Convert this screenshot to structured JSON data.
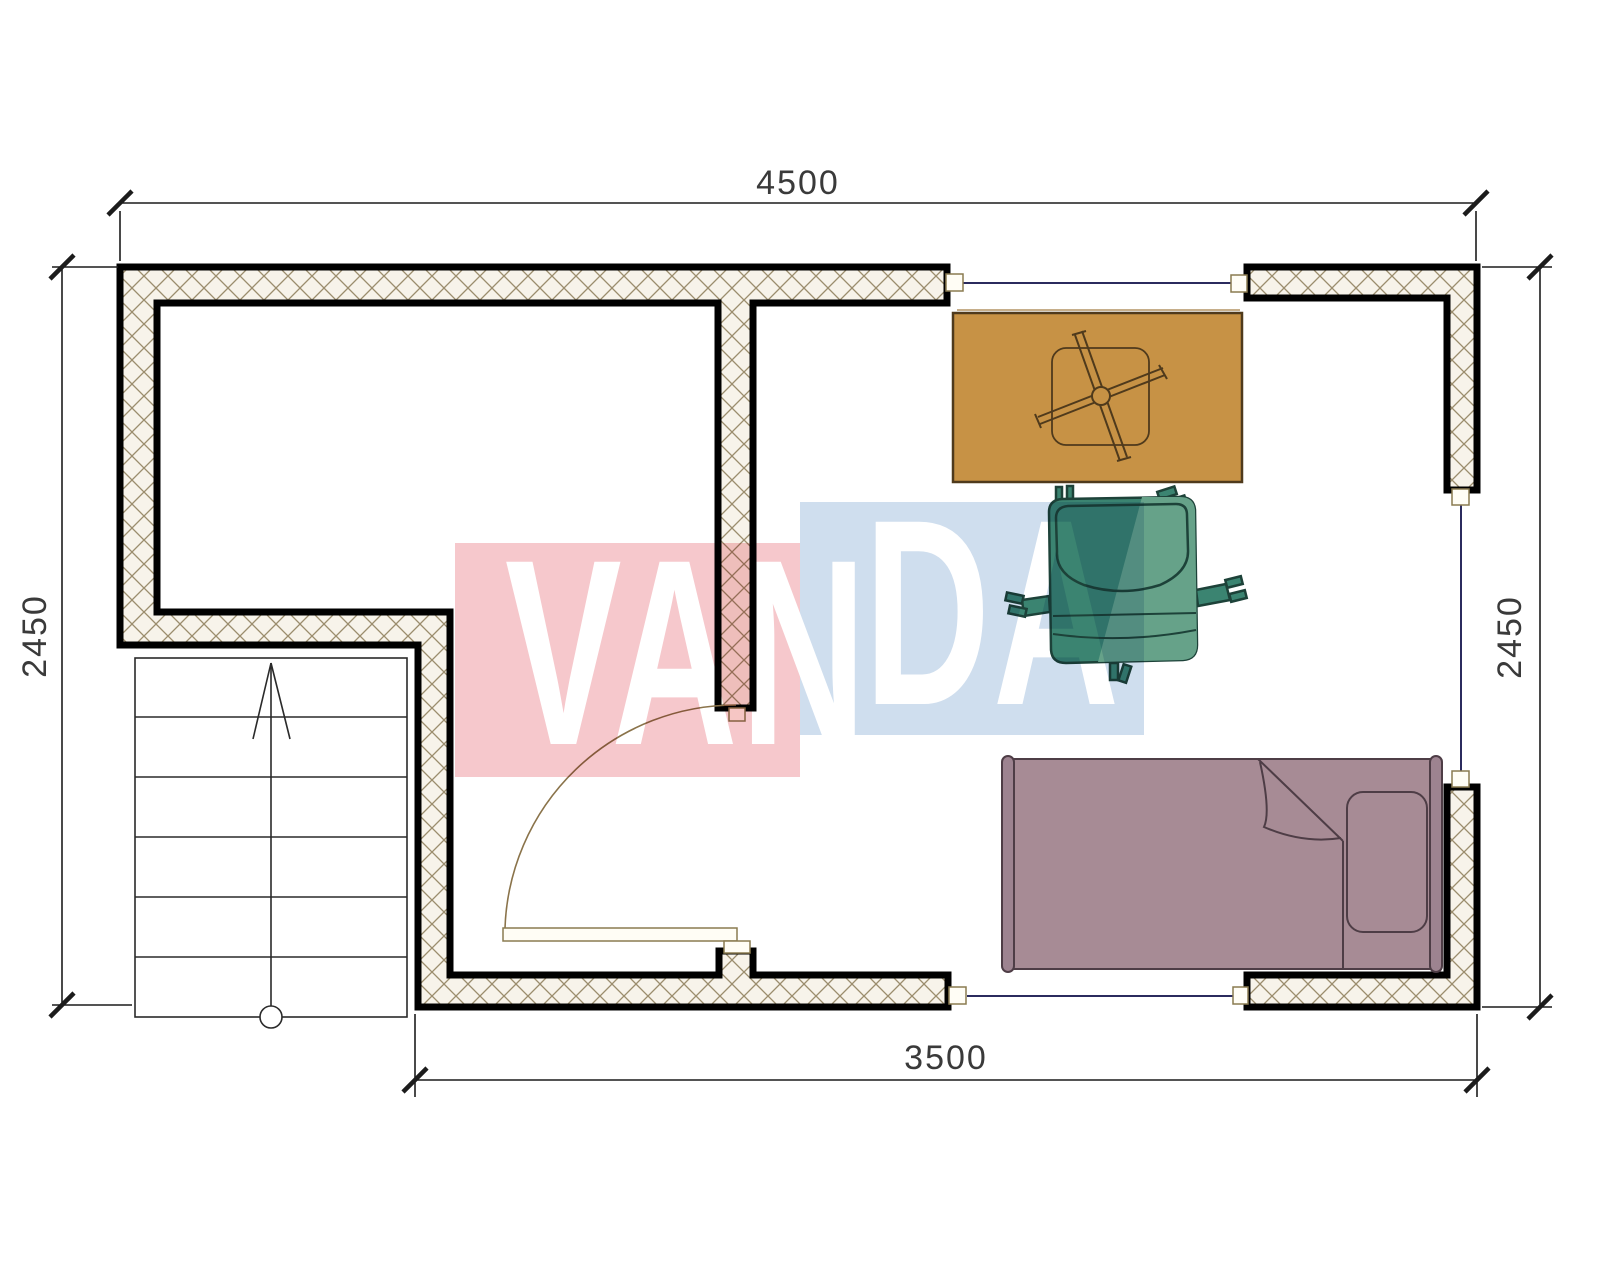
{
  "document": {
    "type": "architectural-floor-plan",
    "description": "Floor plan with staircase, door swing, three window openings, table, armchair and single bed"
  },
  "dimensions": {
    "top": "4500",
    "bottom": "3500",
    "left": "2450",
    "right": "2450"
  },
  "watermark": {
    "text": "VANDA",
    "part1": "VAN",
    "part2": "DA",
    "pink_color": "#f6c8cc",
    "blue_color": "#cfdeee",
    "text_color": "#ffffff"
  },
  "colors": {
    "wall_fill": "#f7f3ea",
    "wall_hatch_line": "#9b8d6d",
    "wall_border": "#000000",
    "window_line": "#2b2b5e",
    "window_sill_line": "#b39363",
    "door_line": "#8a734a",
    "fixture_fill": "#fffdf5",
    "fixture_stroke": "#8a7b50",
    "stairs_line": "#2a2a2a",
    "dim_line": "#1c1c1c",
    "dim_text": "#3a3a3a",
    "table_fill": "#c79245",
    "table_stroke": "#4f3a1c",
    "chair_fill": "#3b8471",
    "chair_fill_light": "#66a289",
    "chair_stroke": "#1d4239",
    "bed_fill": "#a78b95",
    "bed_bar_fill": "#9d8390",
    "bed_stroke": "#4e3d46"
  },
  "elements": {
    "stairs": "staircase-up-arrow",
    "door": "door-90deg-swing",
    "window_top": "window-opening-top",
    "window_right": "window-opening-right",
    "window_bottom": "window-opening-bottom",
    "table": "table-top-view",
    "chair": "armchair-top-view",
    "bed": "single-bed-top-view"
  }
}
